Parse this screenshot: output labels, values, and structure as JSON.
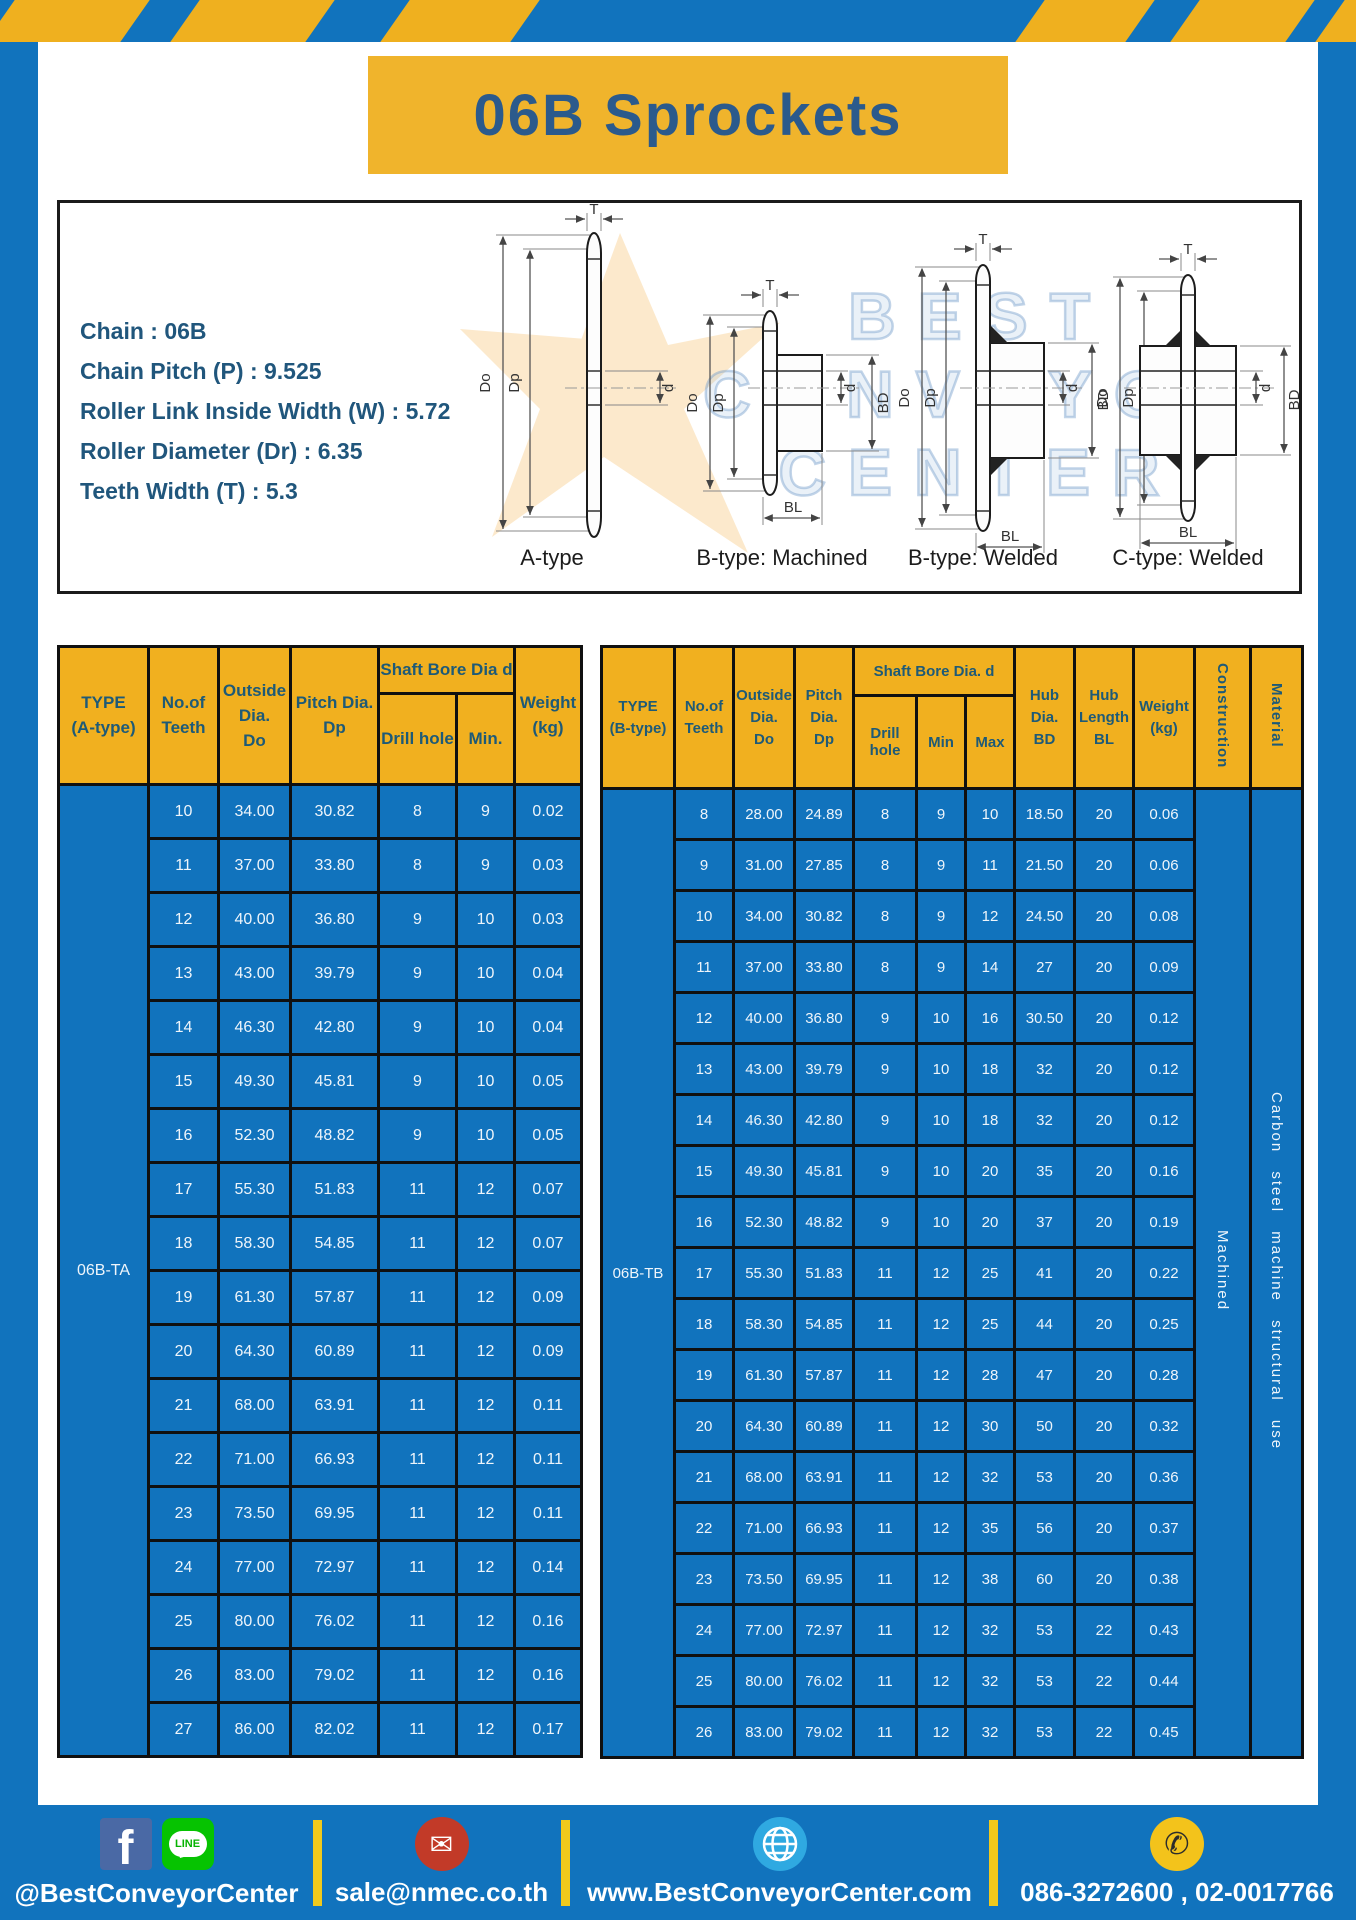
{
  "title": "06B Sprockets",
  "specs": [
    "Chain : 06B",
    "Chain Pitch (P) : 9.525",
    "Roller Link Inside Width (W) : 5.72",
    "Roller Diameter (Dr) : 6.35",
    "Teeth Width (T) : 5.3"
  ],
  "diagram": {
    "labels": [
      "A-type",
      "B-type: Machined",
      "B-type: Welded",
      "C-type: Welded"
    ],
    "dims": {
      "T": "T",
      "Do": "Do",
      "Dp": "Dp",
      "d": "d",
      "BD": "BD",
      "BL": "BL"
    },
    "watermark": [
      "BEST",
      "CONVEYOR",
      "CENTER"
    ]
  },
  "table_a": {
    "type_label": "06B-TA",
    "header": {
      "type": [
        "TYPE",
        "(A-type)"
      ],
      "teeth": [
        "No.of",
        "Teeth"
      ],
      "outside": [
        "Outside",
        "Dia.",
        "Do"
      ],
      "pitch": [
        "Pitch Dia.",
        "Dp"
      ],
      "shaft_bore": "Shaft Bore Dia d",
      "drill": "Drill hole",
      "min": "Min.",
      "weight": [
        "Weight",
        "(kg)"
      ]
    },
    "rows": [
      [
        "10",
        "34.00",
        "30.82",
        "8",
        "9",
        "0.02"
      ],
      [
        "11",
        "37.00",
        "33.80",
        "8",
        "9",
        "0.03"
      ],
      [
        "12",
        "40.00",
        "36.80",
        "9",
        "10",
        "0.03"
      ],
      [
        "13",
        "43.00",
        "39.79",
        "9",
        "10",
        "0.04"
      ],
      [
        "14",
        "46.30",
        "42.80",
        "9",
        "10",
        "0.04"
      ],
      [
        "15",
        "49.30",
        "45.81",
        "9",
        "10",
        "0.05"
      ],
      [
        "16",
        "52.30",
        "48.82",
        "9",
        "10",
        "0.05"
      ],
      [
        "17",
        "55.30",
        "51.83",
        "11",
        "12",
        "0.07"
      ],
      [
        "18",
        "58.30",
        "54.85",
        "11",
        "12",
        "0.07"
      ],
      [
        "19",
        "61.30",
        "57.87",
        "11",
        "12",
        "0.09"
      ],
      [
        "20",
        "64.30",
        "60.89",
        "11",
        "12",
        "0.09"
      ],
      [
        "21",
        "68.00",
        "63.91",
        "11",
        "12",
        "0.11"
      ],
      [
        "22",
        "71.00",
        "66.93",
        "11",
        "12",
        "0.11"
      ],
      [
        "23",
        "73.50",
        "69.95",
        "11",
        "12",
        "0.11"
      ],
      [
        "24",
        "77.00",
        "72.97",
        "11",
        "12",
        "0.14"
      ],
      [
        "25",
        "80.00",
        "76.02",
        "11",
        "12",
        "0.16"
      ],
      [
        "26",
        "83.00",
        "79.02",
        "11",
        "12",
        "0.16"
      ],
      [
        "27",
        "86.00",
        "82.02",
        "11",
        "12",
        "0.17"
      ]
    ]
  },
  "table_b": {
    "type_label": "06B-TB",
    "construction": "Machined",
    "material": "Carbon steel machine structural use",
    "header": {
      "type": [
        "TYPE",
        "(B-type)"
      ],
      "teeth": [
        "No.of",
        "Teeth"
      ],
      "outside": [
        "Outside",
        "Dia.",
        "Do"
      ],
      "pitch": [
        "Pitch",
        "Dia.",
        "Dp"
      ],
      "shaft_bore": "Shaft Bore Dia. d",
      "drill": "Drill hole",
      "min": "Min",
      "max": "Max",
      "hub_dia": [
        "Hub",
        "Dia.",
        "BD"
      ],
      "hub_len": [
        "Hub",
        "Length",
        "BL"
      ],
      "weight": [
        "Weight",
        "(kg)"
      ],
      "construction": "Construction",
      "material": "Material"
    },
    "rows": [
      [
        "8",
        "28.00",
        "24.89",
        "8",
        "9",
        "10",
        "18.50",
        "20",
        "0.06"
      ],
      [
        "9",
        "31.00",
        "27.85",
        "8",
        "9",
        "11",
        "21.50",
        "20",
        "0.06"
      ],
      [
        "10",
        "34.00",
        "30.82",
        "8",
        "9",
        "12",
        "24.50",
        "20",
        "0.08"
      ],
      [
        "11",
        "37.00",
        "33.80",
        "8",
        "9",
        "14",
        "27",
        "20",
        "0.09"
      ],
      [
        "12",
        "40.00",
        "36.80",
        "9",
        "10",
        "16",
        "30.50",
        "20",
        "0.12"
      ],
      [
        "13",
        "43.00",
        "39.79",
        "9",
        "10",
        "18",
        "32",
        "20",
        "0.12"
      ],
      [
        "14",
        "46.30",
        "42.80",
        "9",
        "10",
        "18",
        "32",
        "20",
        "0.12"
      ],
      [
        "15",
        "49.30",
        "45.81",
        "9",
        "10",
        "20",
        "35",
        "20",
        "0.16"
      ],
      [
        "16",
        "52.30",
        "48.82",
        "9",
        "10",
        "20",
        "37",
        "20",
        "0.19"
      ],
      [
        "17",
        "55.30",
        "51.83",
        "11",
        "12",
        "25",
        "41",
        "20",
        "0.22"
      ],
      [
        "18",
        "58.30",
        "54.85",
        "11",
        "12",
        "25",
        "44",
        "20",
        "0.25"
      ],
      [
        "19",
        "61.30",
        "57.87",
        "11",
        "12",
        "28",
        "47",
        "20",
        "0.28"
      ],
      [
        "20",
        "64.30",
        "60.89",
        "11",
        "12",
        "30",
        "50",
        "20",
        "0.32"
      ],
      [
        "21",
        "68.00",
        "63.91",
        "11",
        "12",
        "32",
        "53",
        "20",
        "0.36"
      ],
      [
        "22",
        "71.00",
        "66.93",
        "11",
        "12",
        "35",
        "56",
        "20",
        "0.37"
      ],
      [
        "23",
        "73.50",
        "69.95",
        "11",
        "12",
        "38",
        "60",
        "20",
        "0.38"
      ],
      [
        "24",
        "77.00",
        "72.97",
        "11",
        "12",
        "32",
        "53",
        "22",
        "0.43"
      ],
      [
        "25",
        "80.00",
        "76.02",
        "11",
        "12",
        "32",
        "53",
        "22",
        "0.44"
      ],
      [
        "26",
        "83.00",
        "79.02",
        "11",
        "12",
        "32",
        "53",
        "22",
        "0.45"
      ]
    ]
  },
  "footer": {
    "facebook_label": "f",
    "line_label": "LINE",
    "social": "@BestConveyorCenter",
    "email": "sale@nmec.co.th",
    "website": "www.BestConveyorCenter.com",
    "phone": "086-3272600 , 02-0017766"
  },
  "icons": {
    "envelope": "✉",
    "phone_glyph": "✆"
  },
  "colors": {
    "frame_blue": "#1173bd",
    "accent_yellow": "#f0b125",
    "banner_yellow": "#f0b42c",
    "divider_yellow": "#f1c91c",
    "title_text": "#2b5a8c",
    "header_text": "#1e5a77",
    "cell_text": "#eef5fb"
  }
}
